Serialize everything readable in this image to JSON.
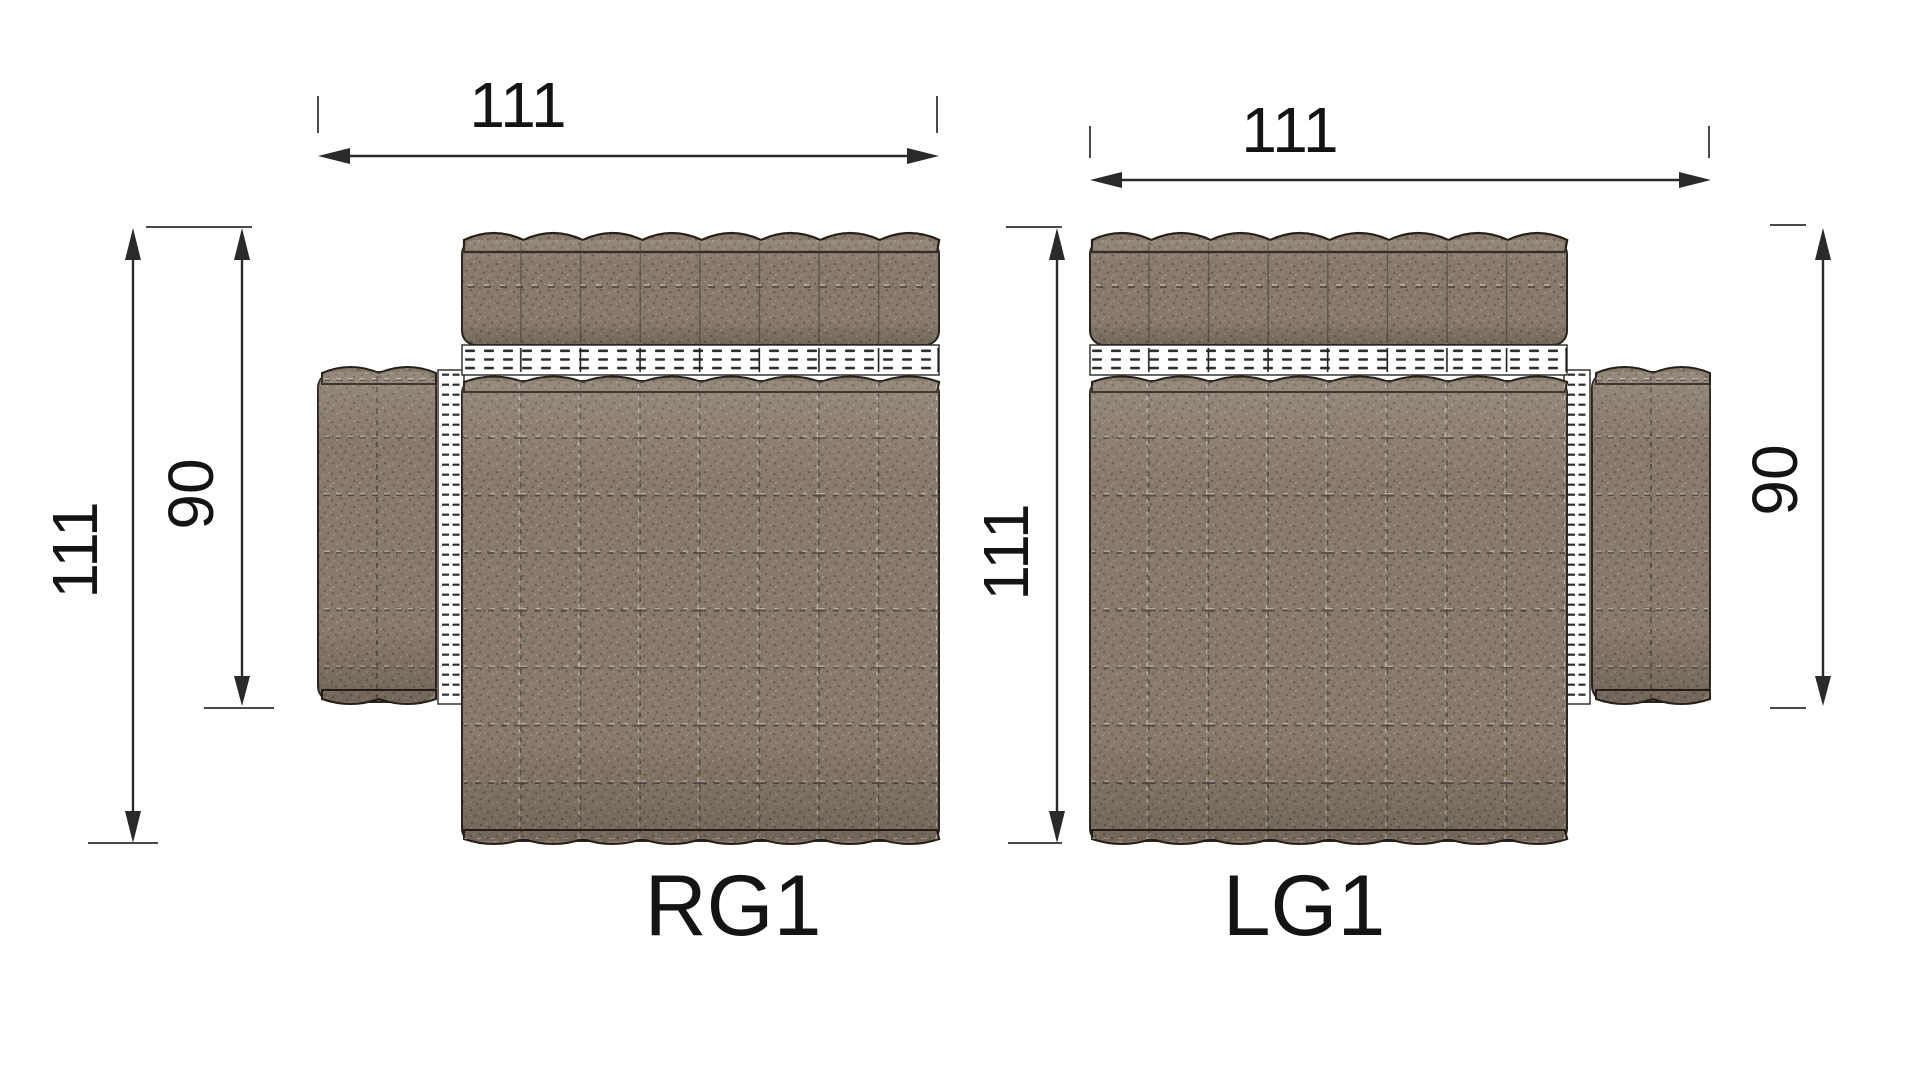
{
  "drawing": {
    "type": "furniture-top-view-dimension-drawing",
    "units_shown": "none (plain numbers)"
  },
  "modules": {
    "rg1": {
      "label": "RG1",
      "dimensions": {
        "width": "111",
        "height": "111",
        "arm_depth": "90"
      },
      "armrest_side": "left"
    },
    "lg1": {
      "label": "LG1",
      "dimensions": {
        "width": "111",
        "height": "111",
        "arm_depth": "90"
      },
      "armrest_side": "right"
    }
  },
  "colors": {
    "background": "#ffffff",
    "fabric_base": "#87796b",
    "fabric_dark_speckle": "#6d6052",
    "fabric_light_speckle": "#9d9081",
    "outline": "#2b2620",
    "stitch": "#2f2f2f",
    "dimension_line": "#2a2a2a",
    "text": "#141414"
  }
}
